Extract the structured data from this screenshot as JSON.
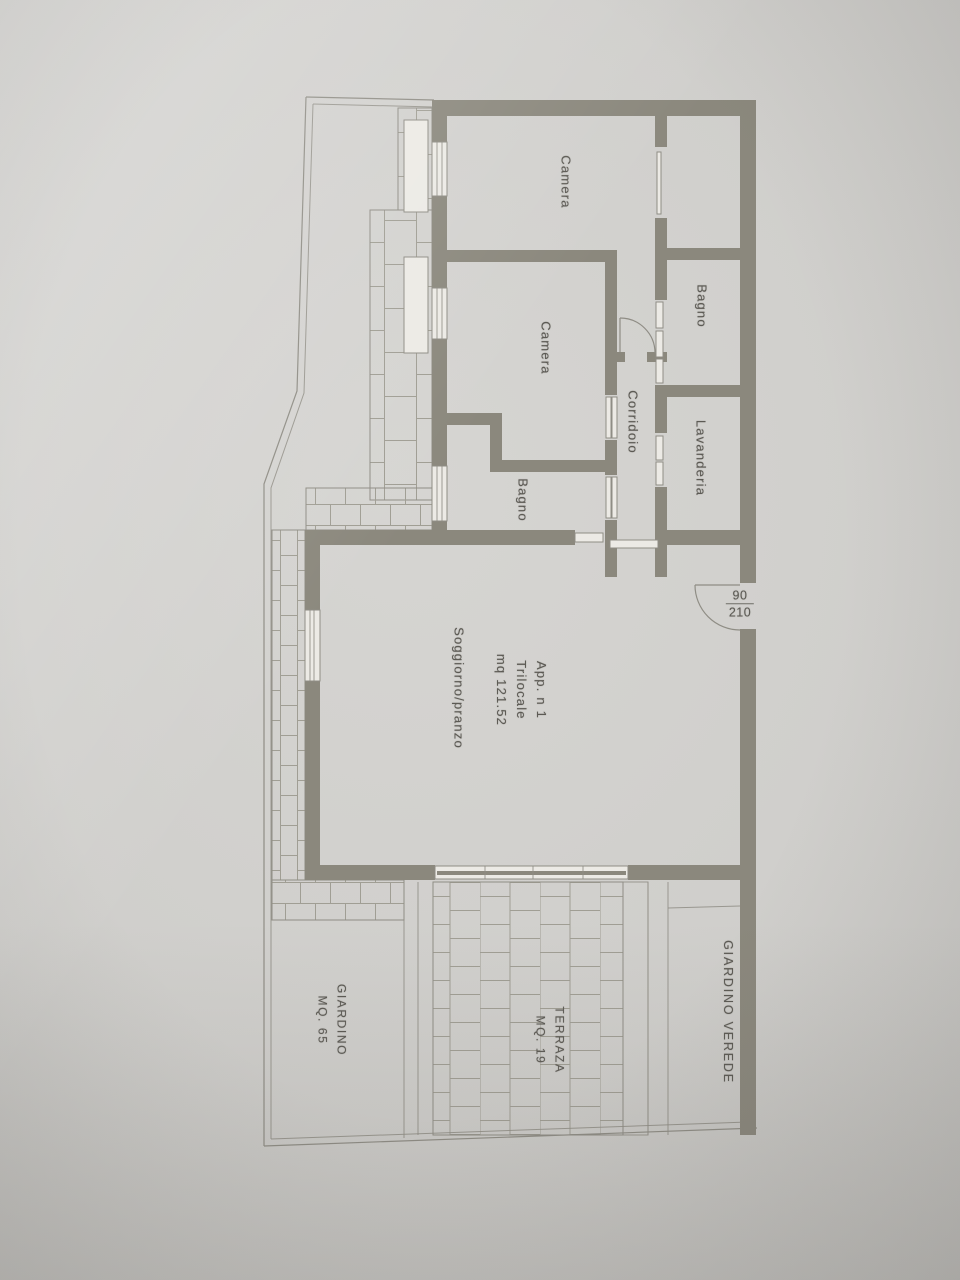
{
  "plan": {
    "rooms": {
      "camera_top": "Camera",
      "bagno_top": "Bagno",
      "camera_mid": "Camera",
      "corridoio": "Corridoio",
      "lavanderia": "Lavanderia",
      "bagno_mid": "Bagno",
      "soggiorno": "Soggiorno/pranzo"
    },
    "apartment_info": {
      "line1": "App. n 1",
      "line2": "Trilocale",
      "line3": "mq 121.52"
    },
    "entry_door_dimension": {
      "numerator": "90",
      "denominator": "210"
    },
    "outdoor": {
      "giardino_line1": "GIARDINO",
      "giardino_line2": "MQ. 65",
      "terrazza_line1": "TERRAZA",
      "terrazza_line2": "MQ. 19",
      "giardino_verede": "GIARDINO VEREDE"
    },
    "colors": {
      "wall": "#8b887d",
      "line": "#8f8d85",
      "ink": "#5c5a54",
      "paper": "#cfcecb"
    }
  }
}
